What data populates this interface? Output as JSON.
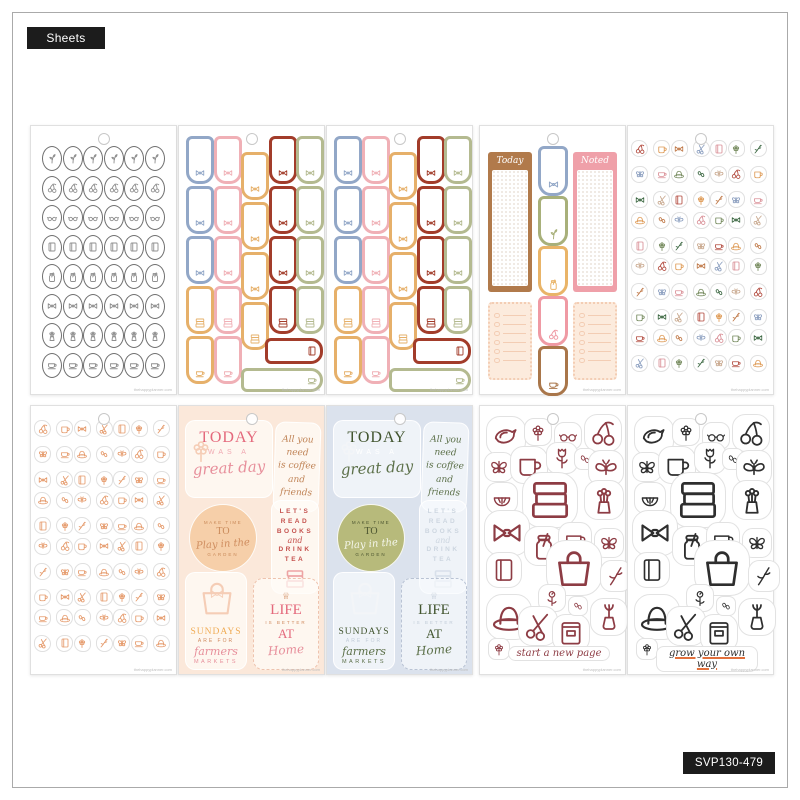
{
  "page": {
    "type_badge": "Sheets",
    "sku_badge": "SVP130-479",
    "watermark": "thehappyplanner.com"
  },
  "today_noted": {
    "today_label": "Today",
    "noted_label": "Noted"
  },
  "captions": {
    "maroon_sheet": "start a new page",
    "black_sheet": "grow your own way"
  },
  "quote_texts": {
    "today": {
      "l1": "TODAY",
      "l2": "WAS A",
      "l3": "great day"
    },
    "coffee": {
      "lines": [
        "All you",
        "need",
        "is coffee",
        "and",
        "friends"
      ]
    },
    "garden": {
      "top": "MAKE TIME",
      "mid": "TO",
      "script": "Play in the",
      "bottom": "GARDEN"
    },
    "read": {
      "lines": [
        "LET'S",
        "READ",
        "BOOKS",
        "and",
        "DRINK",
        "TEA"
      ]
    },
    "sundays": {
      "l1": "SUNDAYS",
      "l2": "ARE FOR",
      "l3": "farmers",
      "l4": "MARKETS"
    },
    "life": {
      "l1": "LIFE",
      "l2": "IS BETTER",
      "l3": "AT",
      "l4": "Home"
    }
  },
  "colors": {
    "tab": {
      "blue": "#92a7c7",
      "pink": "#f0b0b6",
      "orange": "#e6b06a",
      "red": "#a23c2a",
      "green": "#b4ba90"
    },
    "today_noted": {
      "brown": "#b17a4b",
      "pink": "#efa0a9",
      "tab_blue": "#92a7c7",
      "tab_green": "#a8b07a",
      "tab_orange": "#e9b468",
      "tab_pink": "#ef9aa4",
      "tab_brown": "#a9764a",
      "note_bg": "#fcebdd",
      "note_edge": "#f3cdb4"
    },
    "scatter_palette": [
      "#b24a3e",
      "#de9a55",
      "#c07a4a",
      "#8da0c0",
      "#d98f96",
      "#74895c",
      "#3f6a45",
      "#c9a98f"
    ],
    "mono_orange": "#e59a6b",
    "oval_outline": "#6f6f6f",
    "oval_icon": "#8f8f8f",
    "collage_maroon": "#8d3c44",
    "collage_black": "#2e2e2e",
    "caption_underline": "#e2703c"
  },
  "quote_themes": [
    {
      "bg": "#fbe8da",
      "sticker": "rgba(255,252,248,0.72)",
      "primary": "#e4697c",
      "light": "#f0a9b2",
      "tan": "#cf8a5e",
      "script": "#e78f9b",
      "coffee": "#c08457",
      "accent": "#c5524e",
      "books_icon": "#eda4a4",
      "alt": "#f0ac56",
      "circle_bg": "#f6cfa9",
      "circle_fg": "#c98a5a",
      "circle_script": "#cf8d5f",
      "box": "#eec3ae",
      "doodle": "#f5cdb6"
    },
    {
      "bg": "#dbe2ed",
      "sticker": "rgba(248,250,253,0.68)",
      "primary": "#42552f",
      "light": "#ffffff",
      "tan": "#c2ccd8",
      "script": "#5c7049",
      "coffee": "#5c7049",
      "accent": "#cdd6e0",
      "books_icon": "#d8e0ea",
      "alt": "#42552f",
      "circle_bg": "#b7ba7b",
      "circle_fg": "#4c5530",
      "circle_script": "#f5f7ec",
      "box": "#b9c3d4",
      "doodle": "#f3f5f8"
    }
  ],
  "sheets": [
    {
      "name": "oval-cameo-stickers",
      "type": "oval-grid",
      "cols": 6,
      "row_icons": [
        "sprig",
        "cherries",
        "glasses",
        "book",
        "jar",
        "bow",
        "bouquet",
        "teacup"
      ]
    },
    {
      "name": "bookmark-tabs-1",
      "type": "tabs"
    },
    {
      "name": "bookmark-tabs-2",
      "type": "tabs"
    },
    {
      "name": "today-noted-lists",
      "type": "today-noted"
    },
    {
      "name": "mini-icons-multicolor",
      "type": "scatter",
      "multicolor": true
    },
    {
      "name": "mini-icons-orange",
      "type": "scatter",
      "multicolor": false
    },
    {
      "name": "quotes-cream",
      "type": "quotes",
      "theme": 0
    },
    {
      "name": "quotes-blue",
      "type": "quotes",
      "theme": 1
    },
    {
      "name": "line-icons-maroon",
      "type": "collage",
      "color_key": "collage_maroon",
      "caption_key": "maroon_sheet",
      "underline": false
    },
    {
      "name": "line-icons-black",
      "type": "collage",
      "color_key": "collage_black",
      "caption_key": "black_sheet",
      "underline": true
    }
  ]
}
